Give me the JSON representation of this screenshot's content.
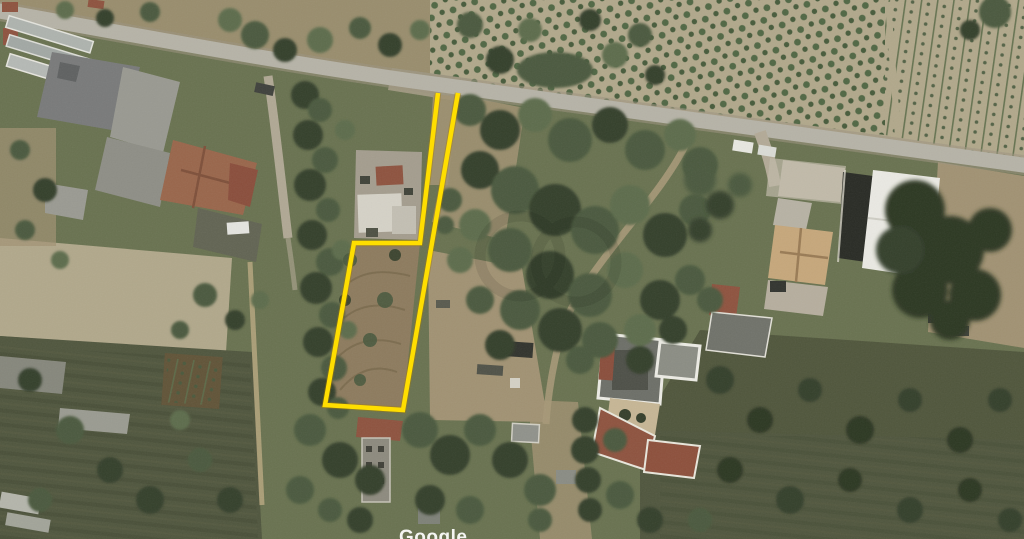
{
  "map": {
    "imagery_watermark": "Google"
  },
  "parcel": {
    "points": "438,93 420,243 354,243 325,405 403,410 458,93"
  },
  "colors": {
    "parcel_outline": "#ffde00",
    "road": "#b8b5a9",
    "soil_light": "#b3a98c",
    "soil_mid": "#a29272",
    "parcel_soil": "#8d7a5c",
    "scrub_dark": "#4c523a",
    "tree_dark": "#2f3a26",
    "tree_mid": "#46563a",
    "roof_orange": "#9a6348",
    "roof_red": "#8e4f3b",
    "roof_beige": "#c9a87b",
    "building_white": "#f0efe9"
  }
}
